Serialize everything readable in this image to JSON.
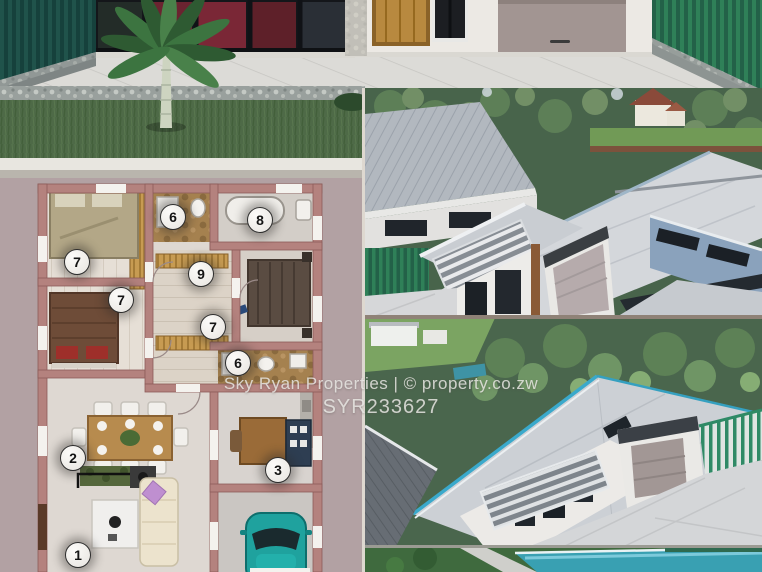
{
  "watermark": {
    "line1": "Sky Ryan Properties | © property.co.zw",
    "line2": "SYR233627"
  },
  "floor_plan": {
    "markers": [
      {
        "label": "6",
        "x": 172,
        "y": 216
      },
      {
        "label": "8",
        "x": 259,
        "y": 219
      },
      {
        "label": "7",
        "x": 76,
        "y": 261
      },
      {
        "label": "9",
        "x": 200,
        "y": 273
      },
      {
        "label": "7",
        "x": 120,
        "y": 299
      },
      {
        "label": "7",
        "x": 212,
        "y": 326
      },
      {
        "label": "6",
        "x": 237,
        "y": 362
      },
      {
        "label": "2",
        "x": 72,
        "y": 457
      },
      {
        "label": "3",
        "x": 277,
        "y": 469
      },
      {
        "label": "1",
        "x": 77,
        "y": 554
      }
    ]
  },
  "colors": {
    "plan_background": "#b2a1a3",
    "plan_wall": "#b4827e",
    "fence_teal": "#1d4a44",
    "fence_green": "#2c7a58",
    "roof_gray": "#d4d7db",
    "wall_blue": "#8aa2bc",
    "trim_teal": "#3aa9cb",
    "car_teal": "#1fa29e",
    "grass_green": "#4f6b4a",
    "watermark_text": "#eceae6"
  }
}
